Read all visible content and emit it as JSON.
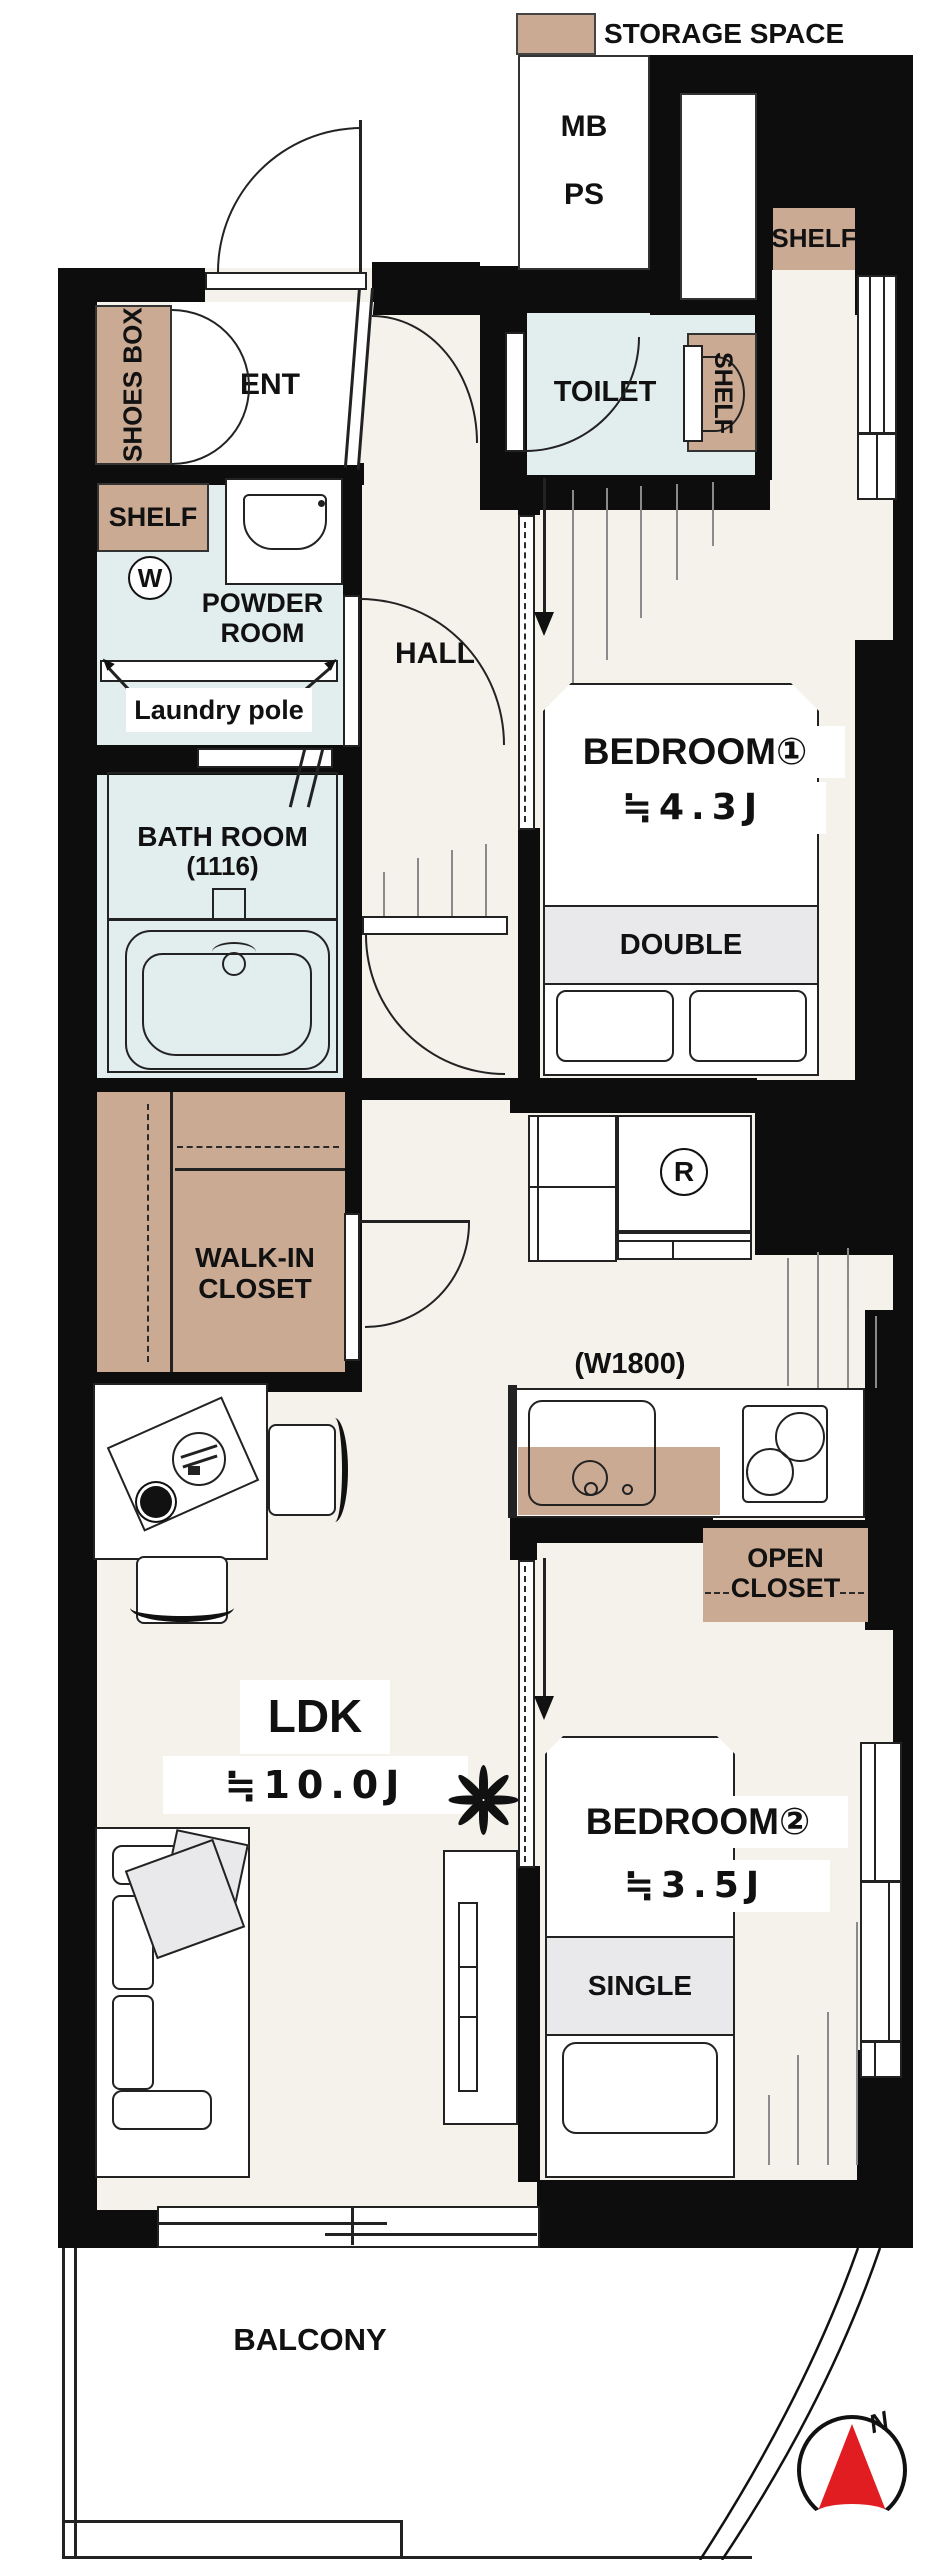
{
  "legend": {
    "label": "STORAGE SPACE"
  },
  "colors": {
    "wall": "#0d0d0d",
    "wet": "#e2edee",
    "storage": "#cbaa94",
    "floor": "#f4f2eb",
    "band": "#e9e9ec",
    "north": "#e21d22",
    "hatch": "#8a8a8a"
  },
  "utility": {
    "mb": "MB",
    "ps": "PS"
  },
  "shelves": {
    "top_right": "SHELF",
    "toilet": "SHELF",
    "powder": "SHELF"
  },
  "entrance": {
    "shoes_box": "SHOES BOX",
    "ent": "ENT"
  },
  "toilet": {
    "label": "TOILET"
  },
  "powder": {
    "line1": "POWDER",
    "line2": "ROOM",
    "washer": "W",
    "laundry_pole": "Laundry pole"
  },
  "hall": {
    "label": "HALL"
  },
  "bath": {
    "line1": "BATH ROOM",
    "line2": "(1116)"
  },
  "bedroom1": {
    "name": "BEDROOM①",
    "size": "≒4.3J",
    "bed": "DOUBLE"
  },
  "bedroom2": {
    "name": "BEDROOM②",
    "size": "≒3.5J",
    "bed": "SINGLE"
  },
  "wic": {
    "line1": "WALK-IN",
    "line2": "CLOSET"
  },
  "kitchen": {
    "width": "(W1800)",
    "fridge": "R"
  },
  "open_closet": {
    "line1": "OPEN",
    "line2": "CLOSET"
  },
  "ldk": {
    "name": "LDK",
    "size": "≒10.0J"
  },
  "balcony": {
    "label": "BALCONY"
  },
  "compass": {
    "north": "N"
  }
}
